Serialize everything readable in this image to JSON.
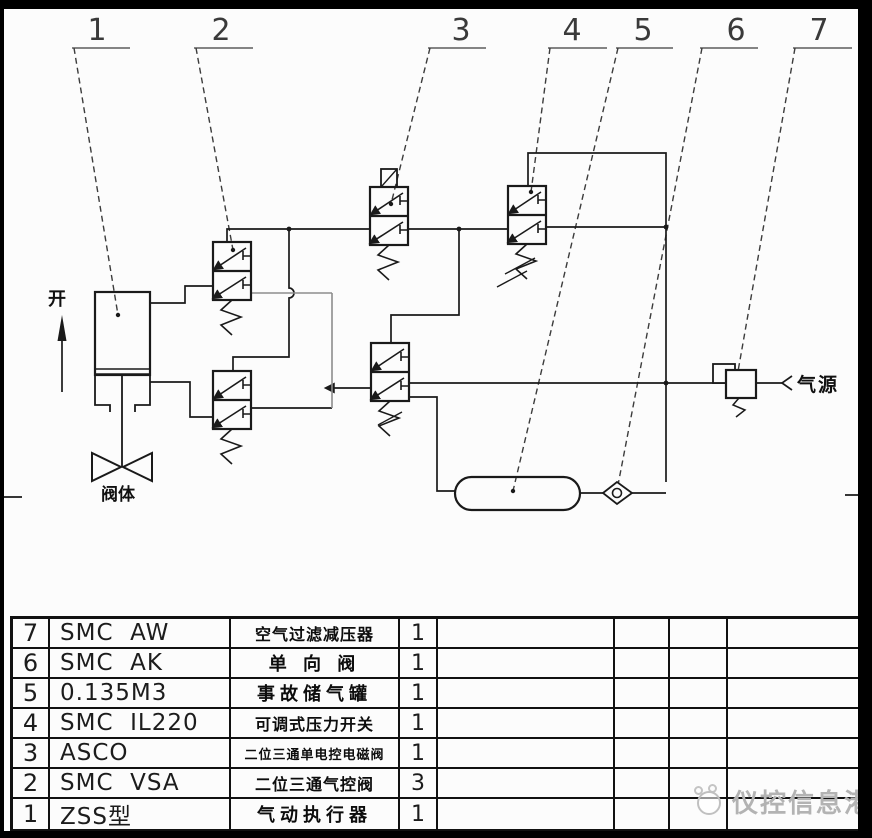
{
  "diagram": {
    "callouts": [
      "1",
      "2",
      "3",
      "4",
      "5",
      "6",
      "7"
    ],
    "labels": {
      "open": "开",
      "valve_body": "阀体",
      "air_source": "气源"
    }
  },
  "table": {
    "rows": [
      {
        "no": "7",
        "model": "SMC  AW",
        "name": "空气过滤减压器",
        "qty": "1"
      },
      {
        "no": "6",
        "model": "SMC  AK",
        "name": "单 向 阀",
        "qty": "1"
      },
      {
        "no": "5",
        "model": "0.135M3",
        "name": "事故储气罐",
        "qty": "1"
      },
      {
        "no": "4",
        "model": "SMC  IL220",
        "name": "可调式压力开关",
        "qty": "1"
      },
      {
        "no": "3",
        "model": "ASCO",
        "name": "二位三通单电控电磁阀",
        "qty": "1"
      },
      {
        "no": "2",
        "model": "SMC  VSA",
        "name": "二位三通气控阀",
        "qty": "3"
      },
      {
        "no": "1",
        "model": "ZSS型",
        "name": "气动执行器",
        "qty": "1"
      }
    ]
  },
  "watermark": {
    "text": "仪控信息港"
  },
  "colors": {
    "line": "#1a1a1a",
    "gray_line": "#8d8d8d",
    "watermark": "#b3b3b3"
  }
}
